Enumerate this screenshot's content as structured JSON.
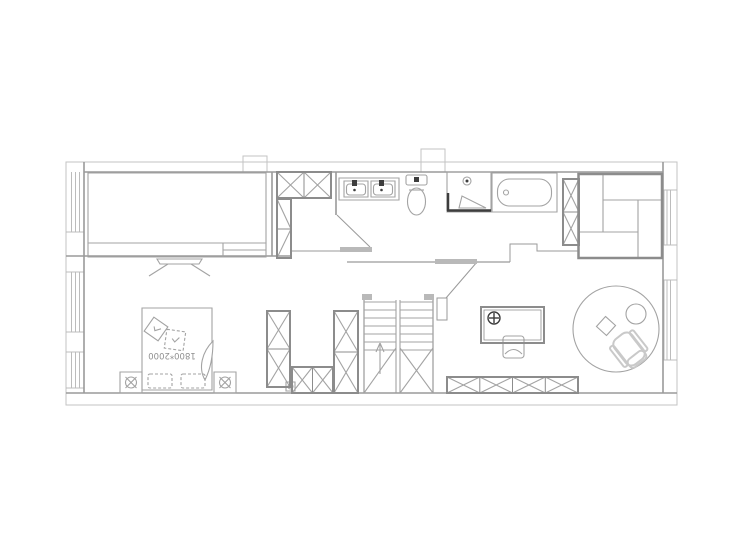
{
  "page": {
    "width": 740,
    "height": 550,
    "background": "#ffffff"
  },
  "colors": {
    "boundary": "#c3c3c3",
    "wall": "#9a9a9a",
    "window": "#bcbcbc",
    "furniture": "#a3a3a3",
    "cabinet": "#8c8c8c",
    "dark": "#3d3d3d",
    "door_fill": "#b9b9b9",
    "chair": "#c9c9c9",
    "text": "#8f8f8f"
  },
  "plan": {
    "type": "residential floor plan, CAD style line drawing",
    "bed_size_label": "1800*2000",
    "rooms": [
      {
        "name": "bedroom",
        "furniture": [
          "wardrobe",
          "tv-stand",
          "double-bed",
          "pillows",
          "throw-cushions",
          "nightstand-left",
          "nightstand-right"
        ]
      },
      {
        "name": "bathroom",
        "furniture": [
          "double-sink-vanity",
          "toilet",
          "shower-enclosure",
          "bathtub",
          "tall-cabinet"
        ]
      },
      {
        "name": "lounge-nook",
        "furniture": [
          "modular-sofa"
        ]
      },
      {
        "name": "study",
        "furniture": [
          "desk",
          "desk-lamp",
          "desk-chair",
          "round-rug",
          "lounge-chair",
          "pouf",
          "floor-cushion",
          "low-cabinet"
        ]
      },
      {
        "name": "hall",
        "furniture": [
          "upper-closet",
          "closet-left",
          "closet-bottom",
          "closet-right",
          "staircase-up"
        ]
      }
    ]
  }
}
